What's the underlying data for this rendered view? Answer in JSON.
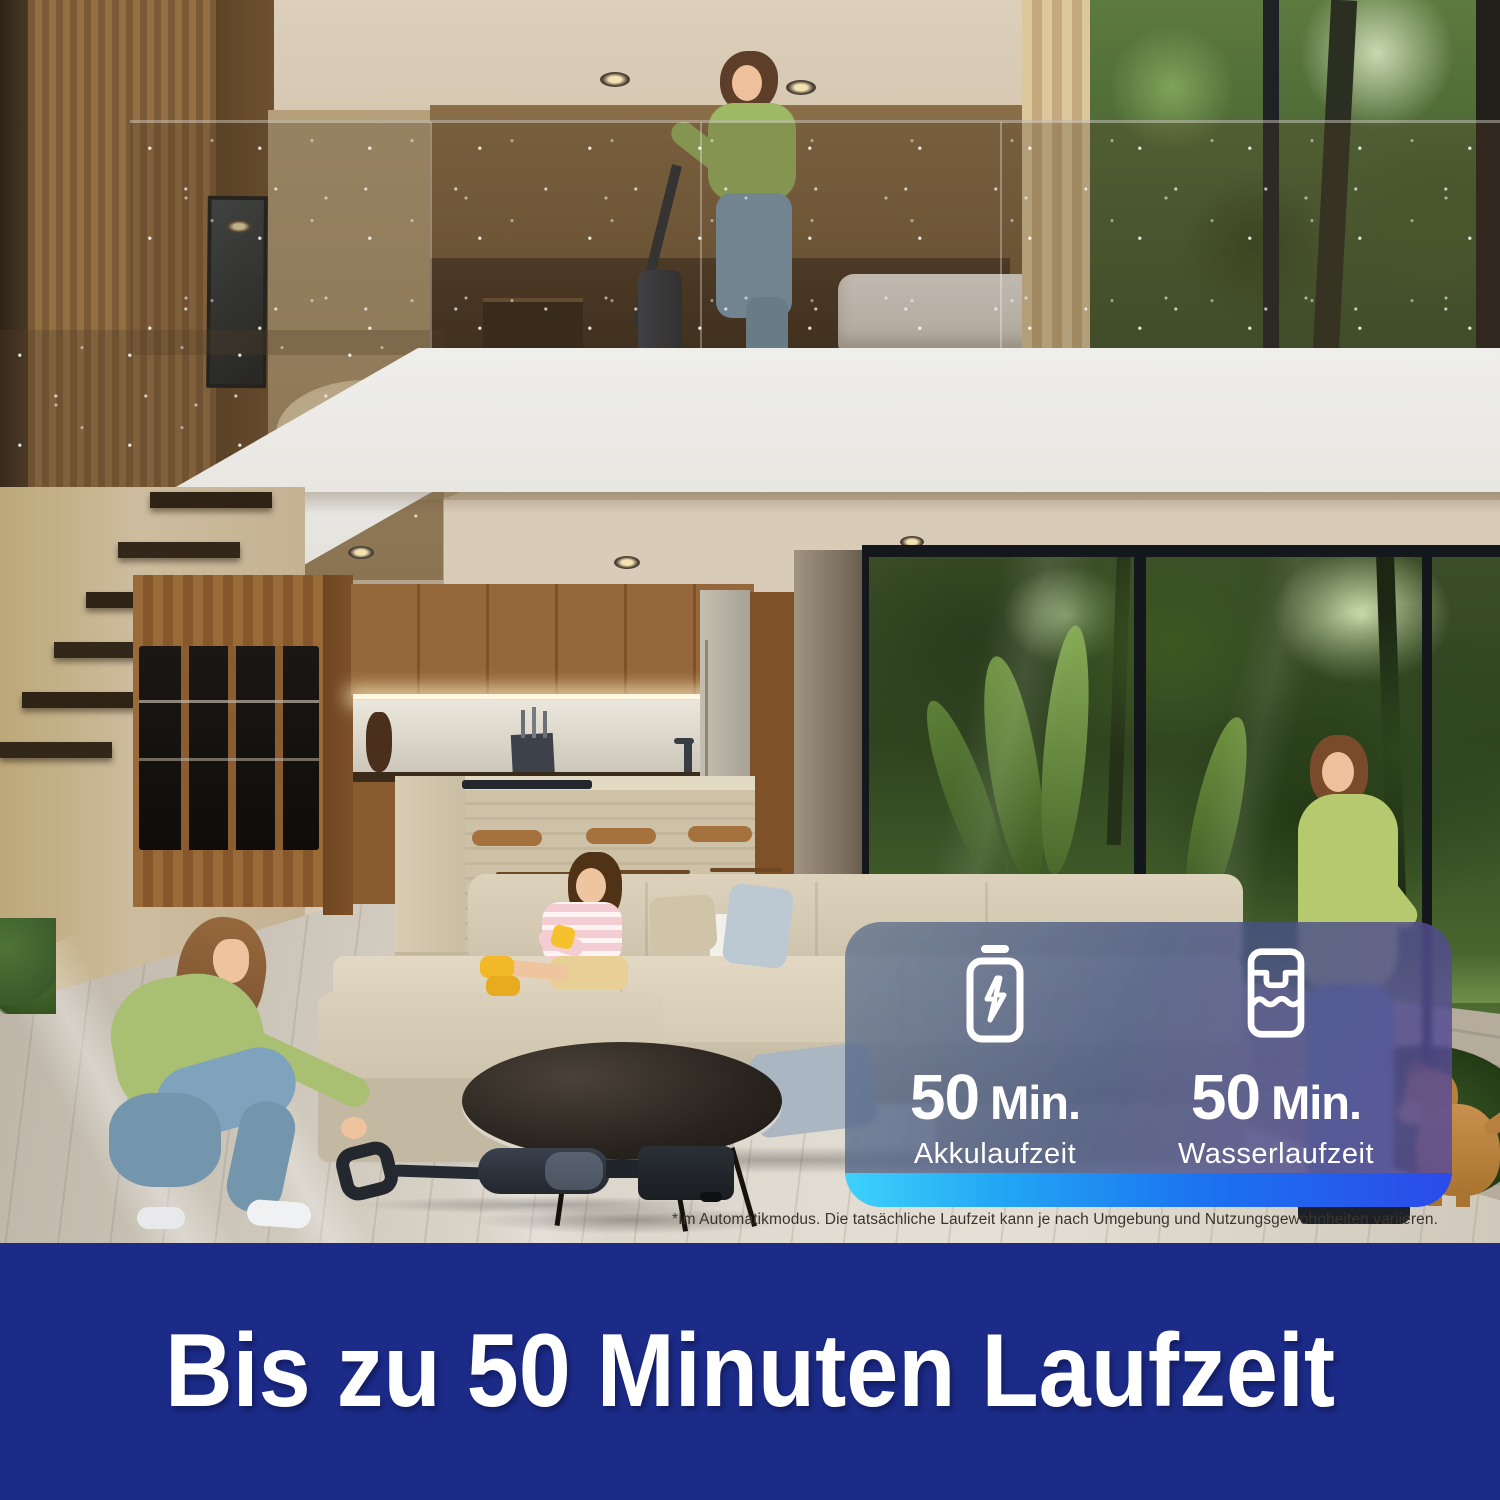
{
  "card": {
    "stats": [
      {
        "icon": "battery-icon",
        "value": "50",
        "unit": "Min.",
        "label": "Akkulaufzeit"
      },
      {
        "icon": "water-tank-icon",
        "value": "50",
        "unit": "Min.",
        "label": "Wasserlaufzeit"
      }
    ],
    "panel_tint_top": "#56688a",
    "panel_tint_bottom": "#5a4a98",
    "strip_gradient": [
      "#3ed2fb",
      "#1b74f0",
      "#2b4ae9"
    ]
  },
  "disclaimer": "*Im Automatikmodus. Die tatsächliche Laufzeit kann je nach Umgebung und Nutzungsgewohnheiten variieren.",
  "banner": {
    "text": "Bis zu 50 Minuten Laufzeit",
    "background": "#1c2b88",
    "color": "#ffffff"
  }
}
